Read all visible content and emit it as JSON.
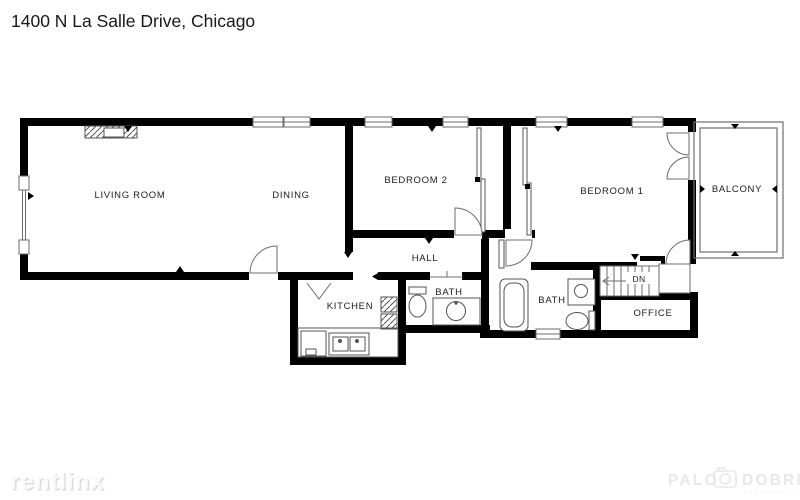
{
  "page": {
    "title": "1400 N La Salle Drive, Chicago",
    "background": "#ffffff"
  },
  "floorplan": {
    "rooms": {
      "living_room": "LIVING ROOM",
      "dining": "DINING",
      "bedroom_2": "BEDROOM 2",
      "bedroom_1": "BEDROOM 1",
      "balcony": "BALCONY",
      "hall": "HALL",
      "kitchen": "KITCHEN",
      "bath_1": "BATH",
      "bath_2": "BATH",
      "office": "OFFICE",
      "stairs": "DN"
    },
    "colors": {
      "wall": "#000000",
      "thin_line": "#6e6e6e",
      "label_text": "#1c1c1c"
    }
  },
  "watermarks": {
    "rentlinx": {
      "text": "rentlinx",
      "color": "#f0f0f0"
    },
    "photographer": {
      "word_1": "PALO",
      "word_2": "DOBRIK",
      "subtext": "PHOTOGRAPHY",
      "color": "#e8e8e8"
    }
  }
}
